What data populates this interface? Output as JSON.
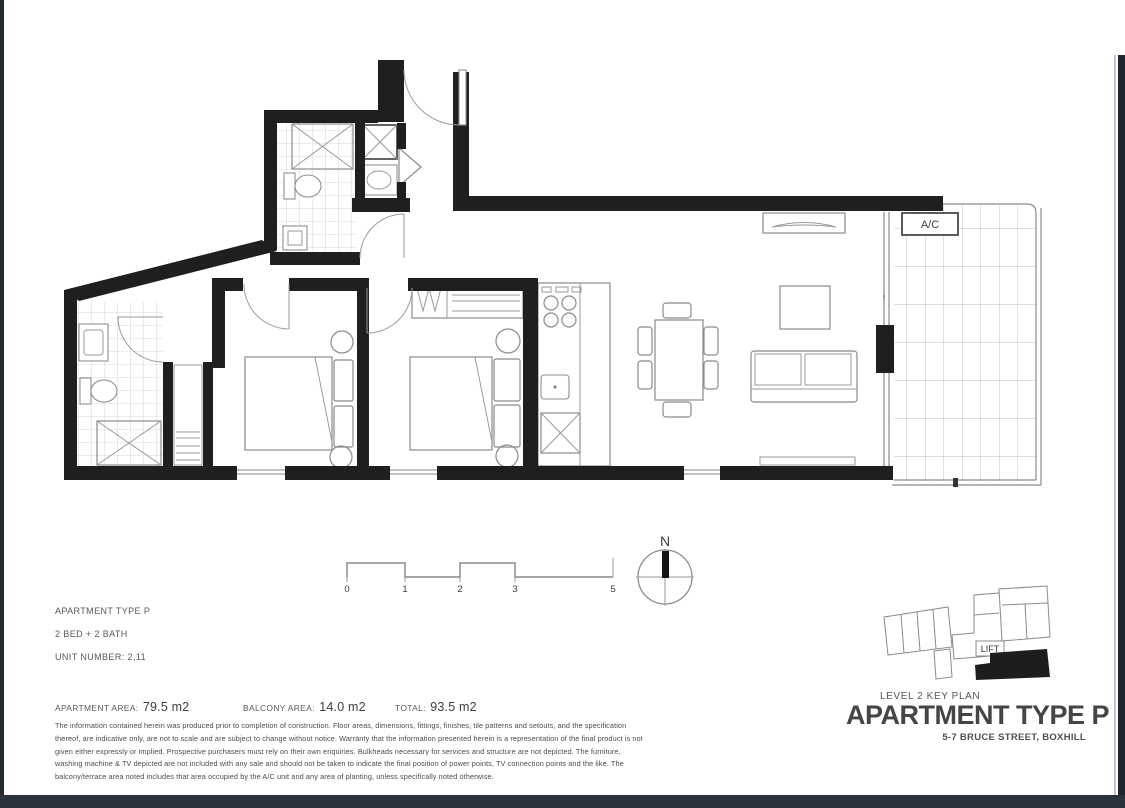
{
  "page": {
    "plan_labels": {
      "ac": "A/C",
      "north": "N",
      "door_arrow": "↑"
    },
    "scale": {
      "ticks": [
        "0",
        "1",
        "2",
        "3",
        "5"
      ]
    },
    "info": {
      "apartment_type": "APARTMENT TYPE P",
      "bed_bath": "2 BED + 2 BATH",
      "unit_number": "UNIT NUMBER: 2,11"
    },
    "areas": {
      "apartment_label": "APARTMENT AREA:",
      "apartment_value": "79.5 m2",
      "balcony_label": "BALCONY AREA:",
      "balcony_value": "14.0 m2",
      "total_label": "TOTAL:",
      "total_value": "93.5 m2"
    },
    "disclaimer_lines": [
      "The information contained herein was produced prior to completion of construction. Floor areas, dimensions, fittings, finishes, tile patterns and setouts, and the specification",
      "thereof, are indicative only, are not to scale and are subject to change without notice. Warranty that the information presented herein is a representation of the final product is not",
      "given either expressly or implied. Prospective purchasers must rely on their own enquiries. Bulkheads necessary for services and structure are not depicted. The furniture,",
      "washing machine & TV depicted are not included with any sale and should not be taken to indicate the final position of power points, TV connection points and the like. The",
      "balcony/terrace area noted includes that area occupied by the A/C unit and any area of planting, unless specifically noted otherwise."
    ],
    "key_plan": {
      "lift": "LIFT",
      "caption": "LEVEL 2 KEY PLAN",
      "title": "APARTMENT TYPE P",
      "subtitle": "5-7 BRUCE STREET, BOXHILL"
    }
  }
}
